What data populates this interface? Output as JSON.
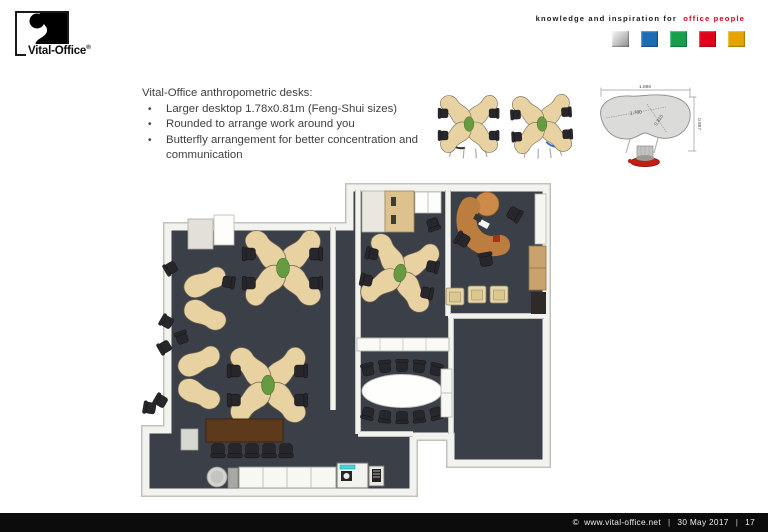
{
  "brand": {
    "logo_text": "Vital-Office",
    "logo_reg": "®",
    "tagline_black": "knowledge and inspiration for",
    "tagline_accent": "office people",
    "squares": [
      {
        "name": "silver",
        "color": "#b9b9b9"
      },
      {
        "name": "blue",
        "color": "#1e6cb4"
      },
      {
        "name": "green",
        "color": "#17a04b"
      },
      {
        "name": "red",
        "color": "#e2001a"
      },
      {
        "name": "gold",
        "color": "#e6a400"
      }
    ]
  },
  "content": {
    "title": "Vital-Office anthropometric desks:",
    "bullet_char": "•",
    "bullets": [
      "Larger desktop 1.78x0.81m (Feng-Shui sizes)",
      "Rounded to arrange work around you",
      "Butterfly arrangement for better concentration and communication"
    ]
  },
  "dimension_drawing": {
    "overall_width": "1.886",
    "top_width": "1.780",
    "diagonal_depth": "0.810",
    "overall_depth": "0.887"
  },
  "floorplan": {
    "element_names": [
      "butterfly-desk-cluster",
      "two-desk-group",
      "executive-desk",
      "meeting-oval-table",
      "conference-table",
      "kitchen-counter",
      "copier",
      "wardrobe-cabinet",
      "armchairs",
      "wall-cabinets"
    ]
  },
  "colors": {
    "accent_red": "#e2001a",
    "floor": "#3a3f48",
    "desk_top": "#e9d2a2",
    "footer_bg": "#0c0c0c"
  },
  "footer": {
    "copyright_symbol": "©",
    "website": "www.vital-office.net",
    "divider": "|",
    "date": "30 May 2017",
    "page": "17"
  }
}
